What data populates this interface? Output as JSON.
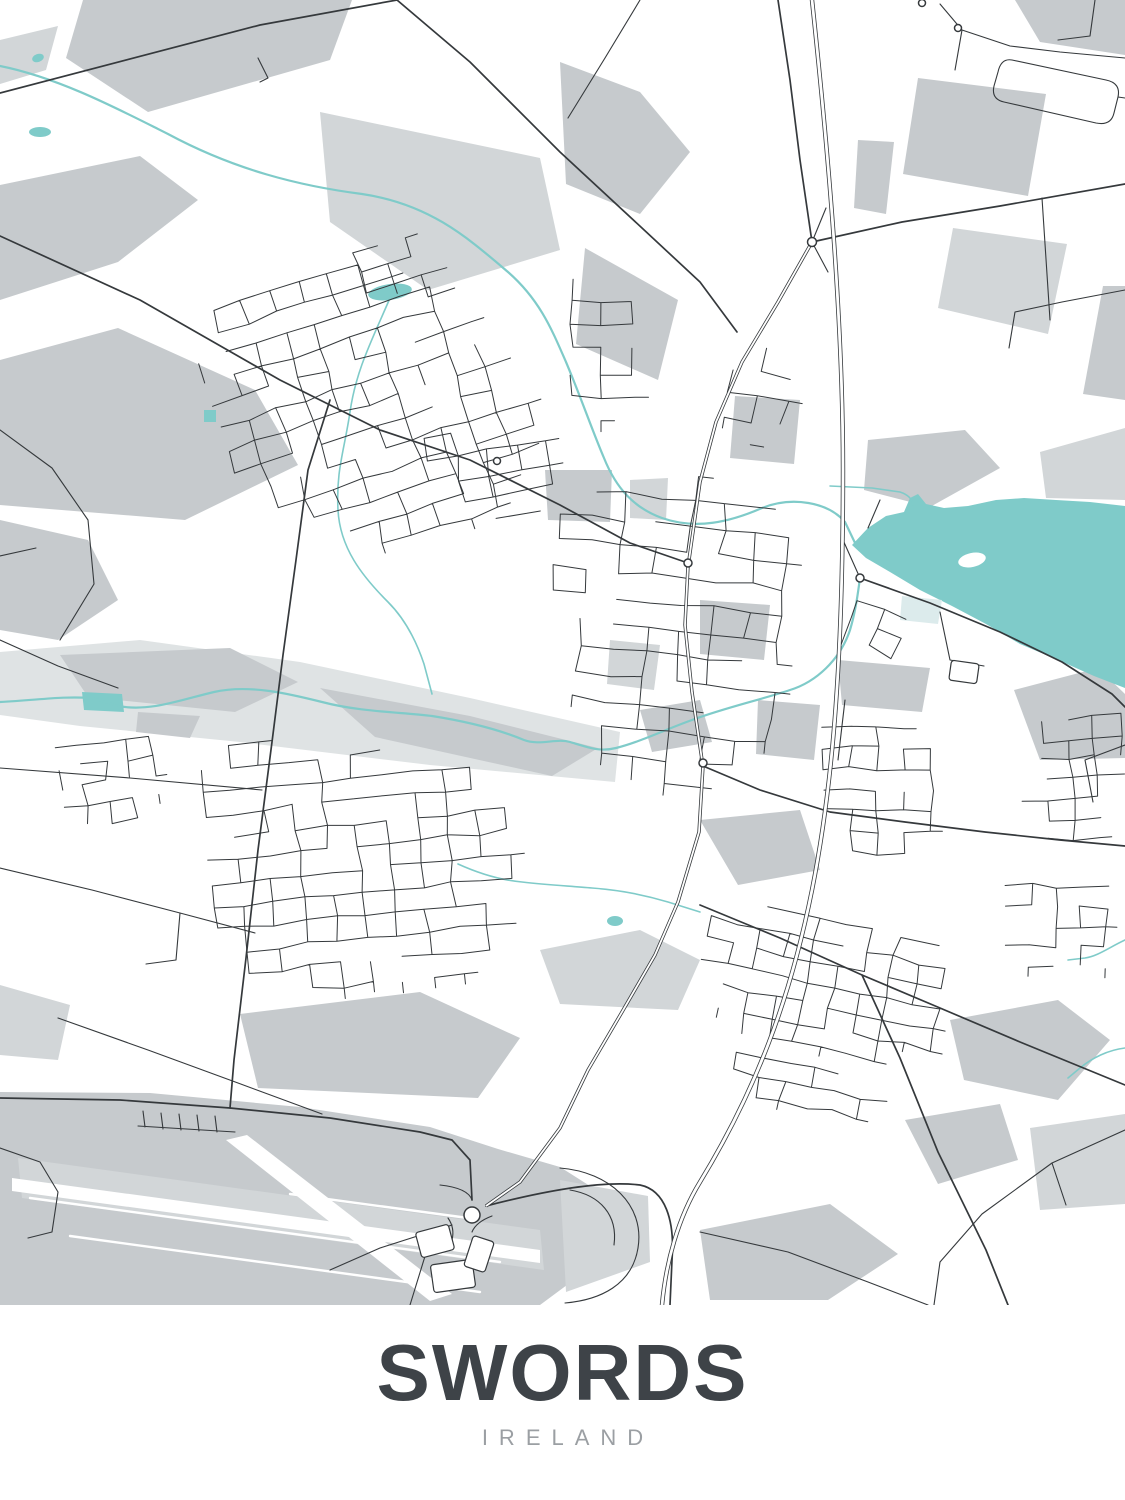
{
  "poster": {
    "title": "SWORDS",
    "subtitle": "IRELAND"
  },
  "colors": {
    "background": "#ffffff",
    "land_field": "#c6cacd",
    "land_field_light": "#d2d6d8",
    "valley": "#dfe3e4",
    "water": "#7fcbc9",
    "water_shallow": "#dcebec",
    "road": "#35393c",
    "title_color": "#3e4348",
    "subtitle_color": "#9b9fa3"
  }
}
